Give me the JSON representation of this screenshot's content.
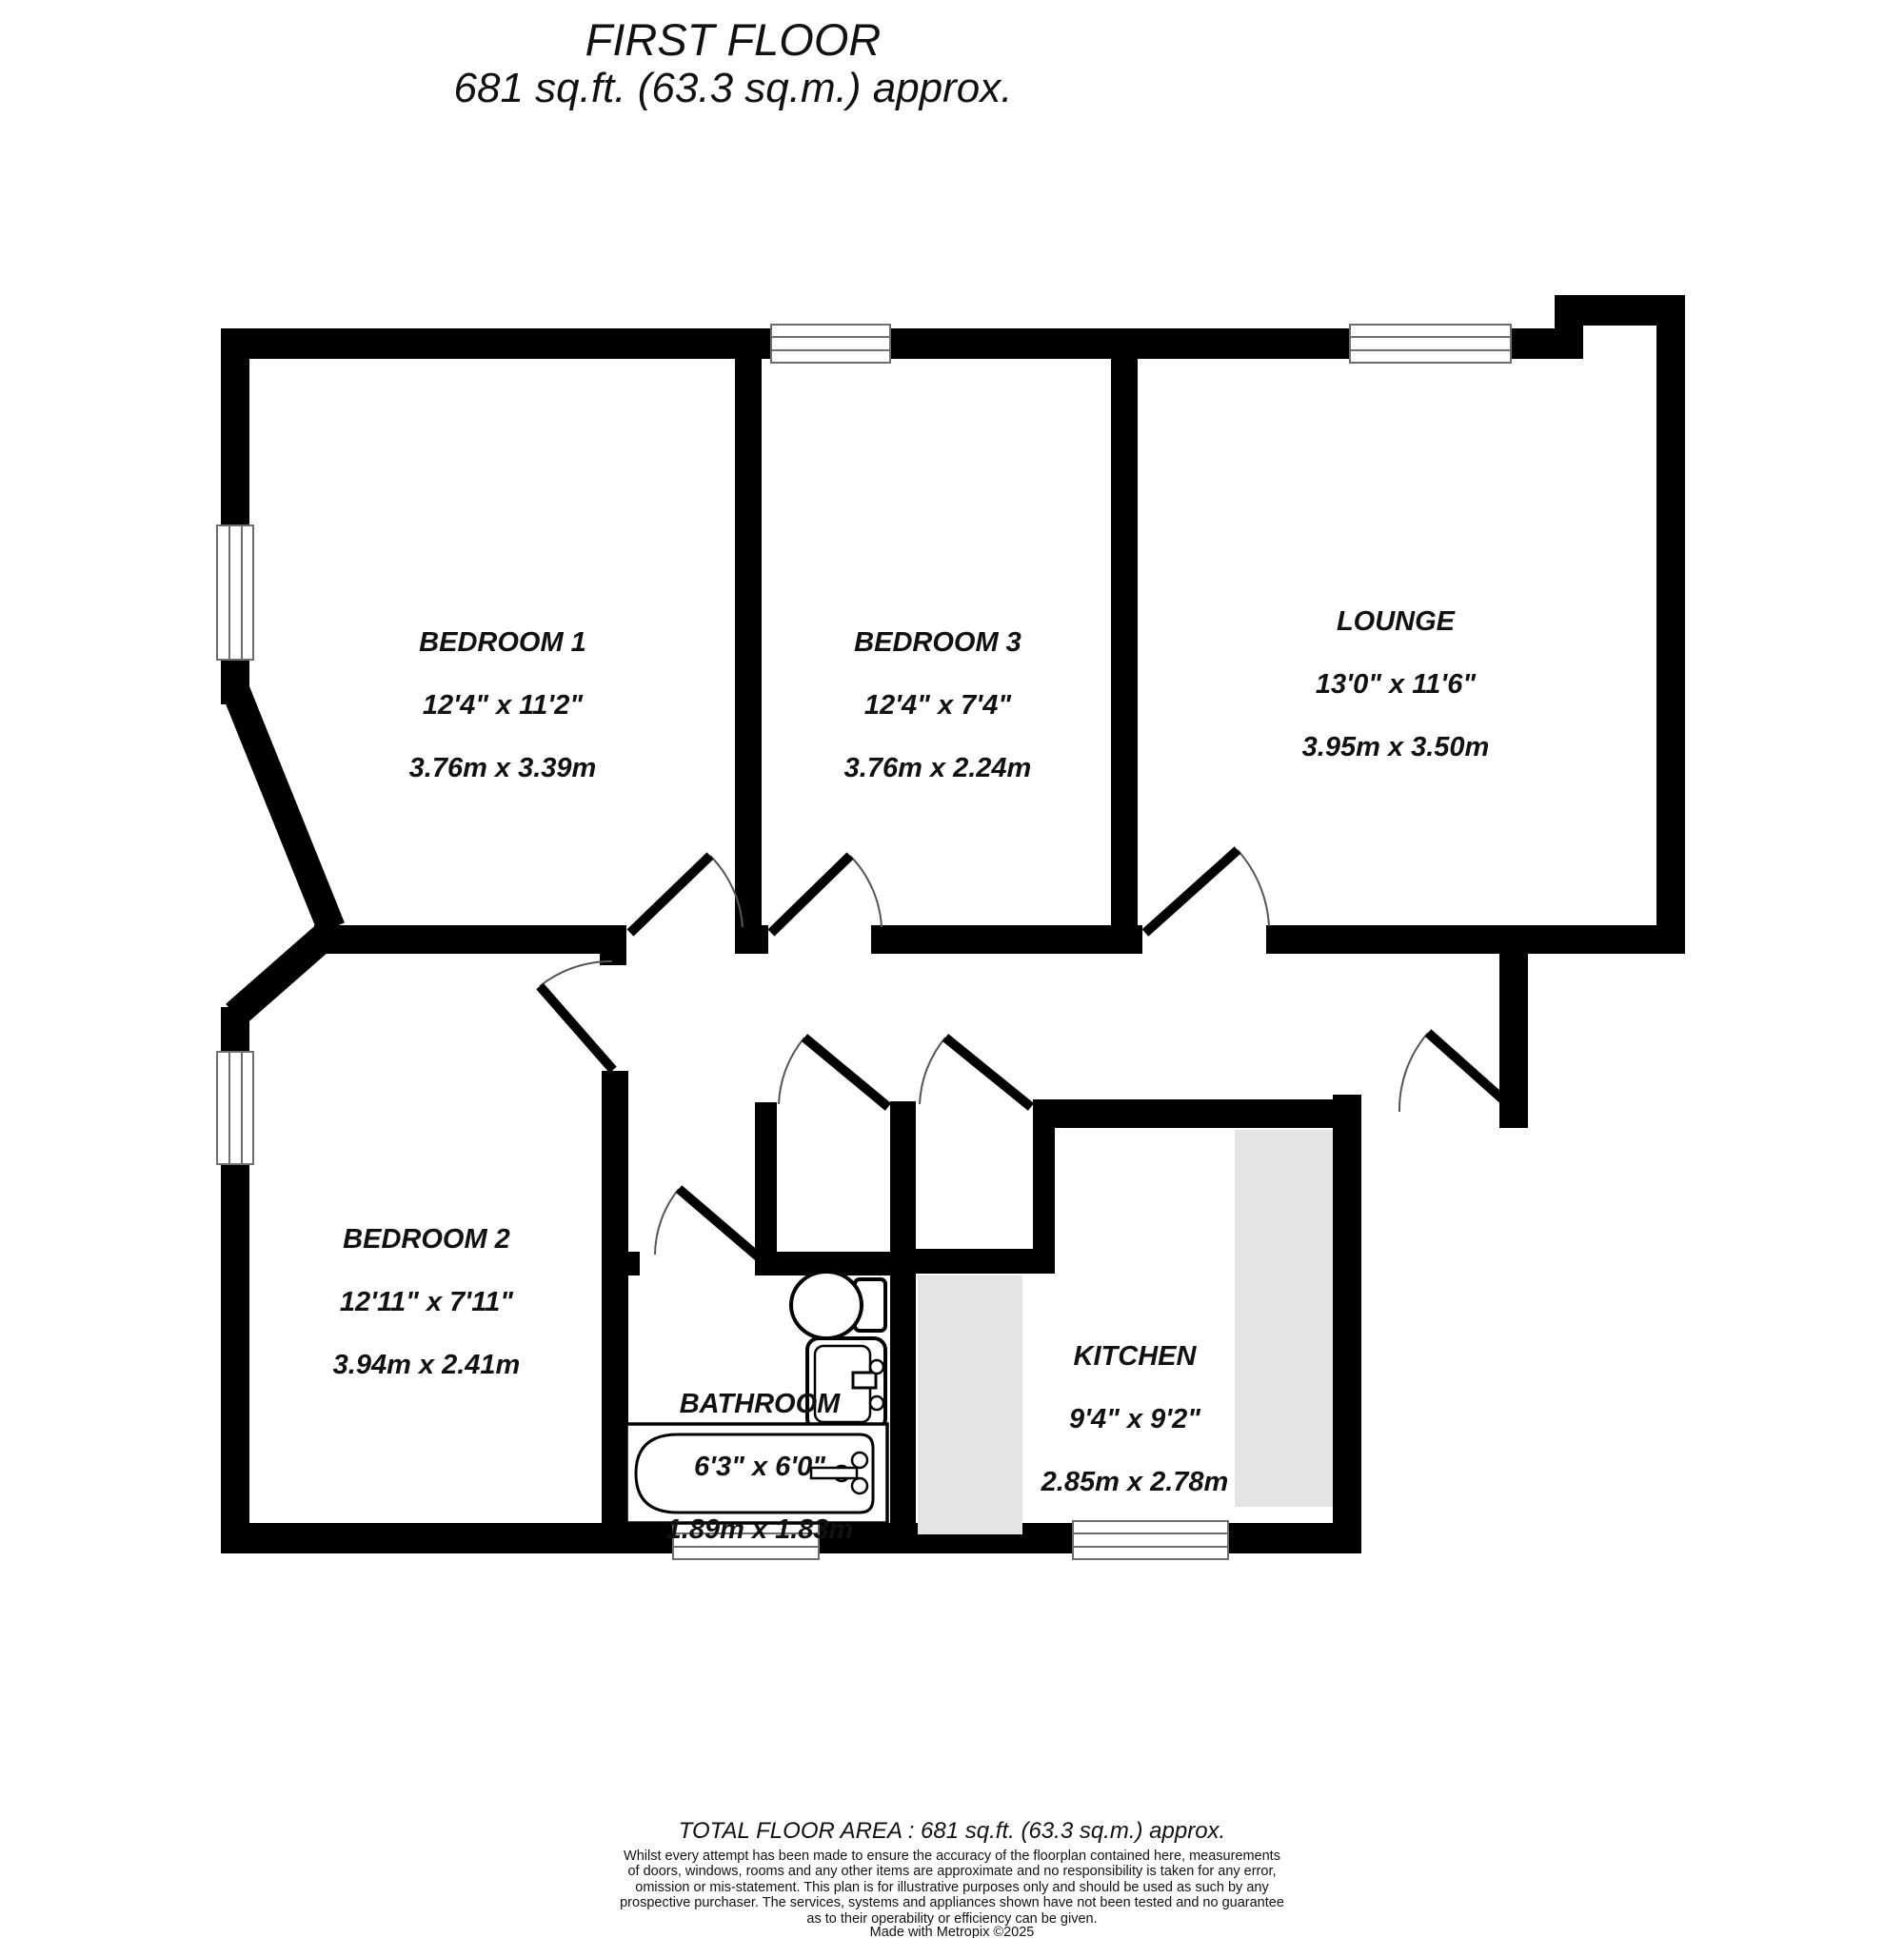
{
  "title": {
    "line1": "FIRST FLOOR",
    "line2": "681 sq.ft. (63.3 sq.m.) approx."
  },
  "rooms": {
    "bedroom1": {
      "name": "BEDROOM 1",
      "imperial": "12'4\"  x 11'2\"",
      "metric": "3.76m  x 3.39m"
    },
    "bedroom3": {
      "name": "BEDROOM 3",
      "imperial": "12'4\"  x 7'4\"",
      "metric": "3.76m  x 2.24m"
    },
    "lounge": {
      "name": "LOUNGE",
      "imperial": "13'0\"  x 11'6\"",
      "metric": "3.95m  x 3.50m"
    },
    "bedroom2": {
      "name": "BEDROOM 2",
      "imperial": "12'11\"  x 7'11\"",
      "metric": "3.94m  x 2.41m"
    },
    "bathroom": {
      "name": "BATHROOM",
      "imperial": "6'3\"  x 6'0\"",
      "metric": "1.89m  x 1.83m"
    },
    "kitchen": {
      "name": "KITCHEN",
      "imperial": "9'4\"  x 9'2\"",
      "metric": "2.85m  x 2.78m"
    }
  },
  "footer": {
    "total_area": "TOTAL FLOOR AREA : 681 sq.ft. (63.3 sq.m.) approx.",
    "disclaimer": "Whilst every attempt has been made to ensure the accuracy of the floorplan contained here, measurements\nof doors, windows, rooms and any other items are approximate and no responsibility is taken for any error,\nomission or mis-statement. This plan is for illustrative purposes only and should be used as such by any\nprospective purchaser. The services, systems and appliances shown have not been tested and no guarantee\nas to their operability or efficiency can be given.",
    "credit": "Made with Metropix ©2025"
  },
  "colors": {
    "wall": "#000000",
    "counter": "#e4e4e4",
    "window_frame": "#6e6e6e",
    "door_arc": "#555555",
    "background": "#ffffff"
  }
}
